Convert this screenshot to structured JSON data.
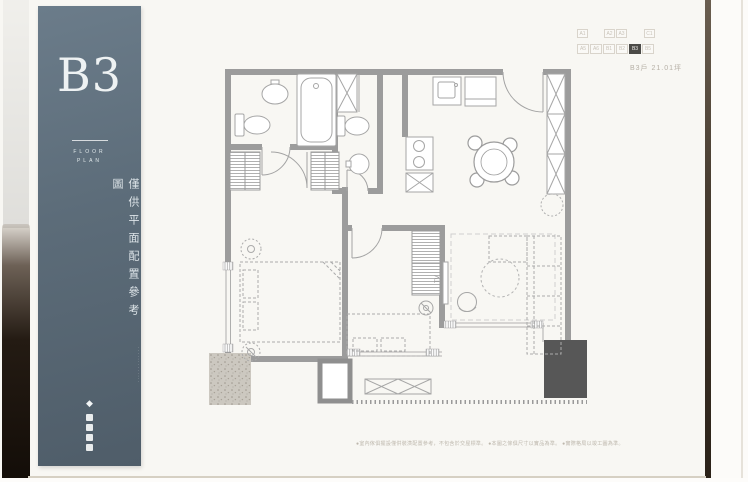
{
  "page": {
    "sidebar": {
      "unit_code": "B3",
      "subtitle_line1": "FLOOR",
      "subtitle_line2": "PLAN",
      "vertical_text": "僅供平面配置參考圖",
      "vertical_microtext": "·············",
      "diamond_icon": "◆",
      "panel_color": "#5c6c79"
    },
    "unit_selector": {
      "row1": [
        "A1",
        "A2",
        "A3",
        "C1"
      ],
      "row2": [
        "A5",
        "A6",
        "B1",
        "B2",
        "B3",
        "B5"
      ],
      "selected": "B3",
      "selected_color": "#4b4a47"
    },
    "unit_info": "B3戶 21.01坪",
    "floor_plan": {
      "tv_label": "TV",
      "wall_color": "#9c9c9c",
      "dark_block_color": "#575757"
    },
    "disclaimer": "●室內傢俱擺設僅供裝潢配置參考，不包含於交屋標準。 ●本圖之傢俱尺寸以實品為準。 ●實際格局以竣工圖為準。"
  }
}
